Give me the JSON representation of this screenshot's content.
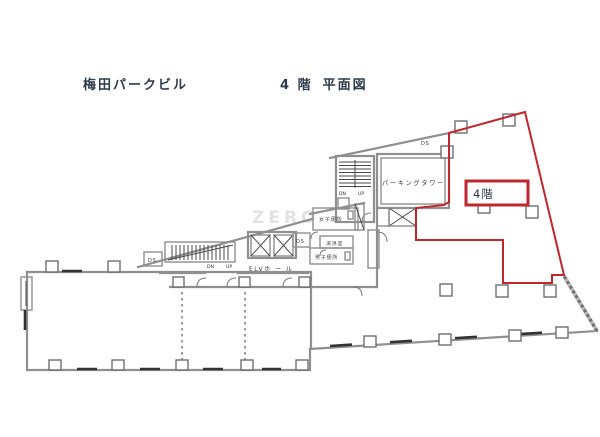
{
  "title": {
    "building": "梅田パークビル",
    "floor_label": "4 階",
    "plan_label": "平面図"
  },
  "highlight": {
    "label": "4階"
  },
  "rooms": {
    "parking_tower": "パーキングタワー",
    "elv_hall": "ELVホ ー ル",
    "womens_toilet": "女子便所",
    "hot_water_room": "湯沸室",
    "mens_toilet": "男子便所"
  },
  "stairs": {
    "dn": "DN",
    "up": "UP"
  },
  "shafts": {
    "ds": "DS"
  },
  "watermark": "ZERO",
  "colors": {
    "highlight_red": "#c0272d",
    "wall_grey": "#8f8f8f",
    "detail_dark": "#4a4a4a",
    "title_text": "#2e3a4e",
    "watermark_grey": "#e2e2e2"
  }
}
